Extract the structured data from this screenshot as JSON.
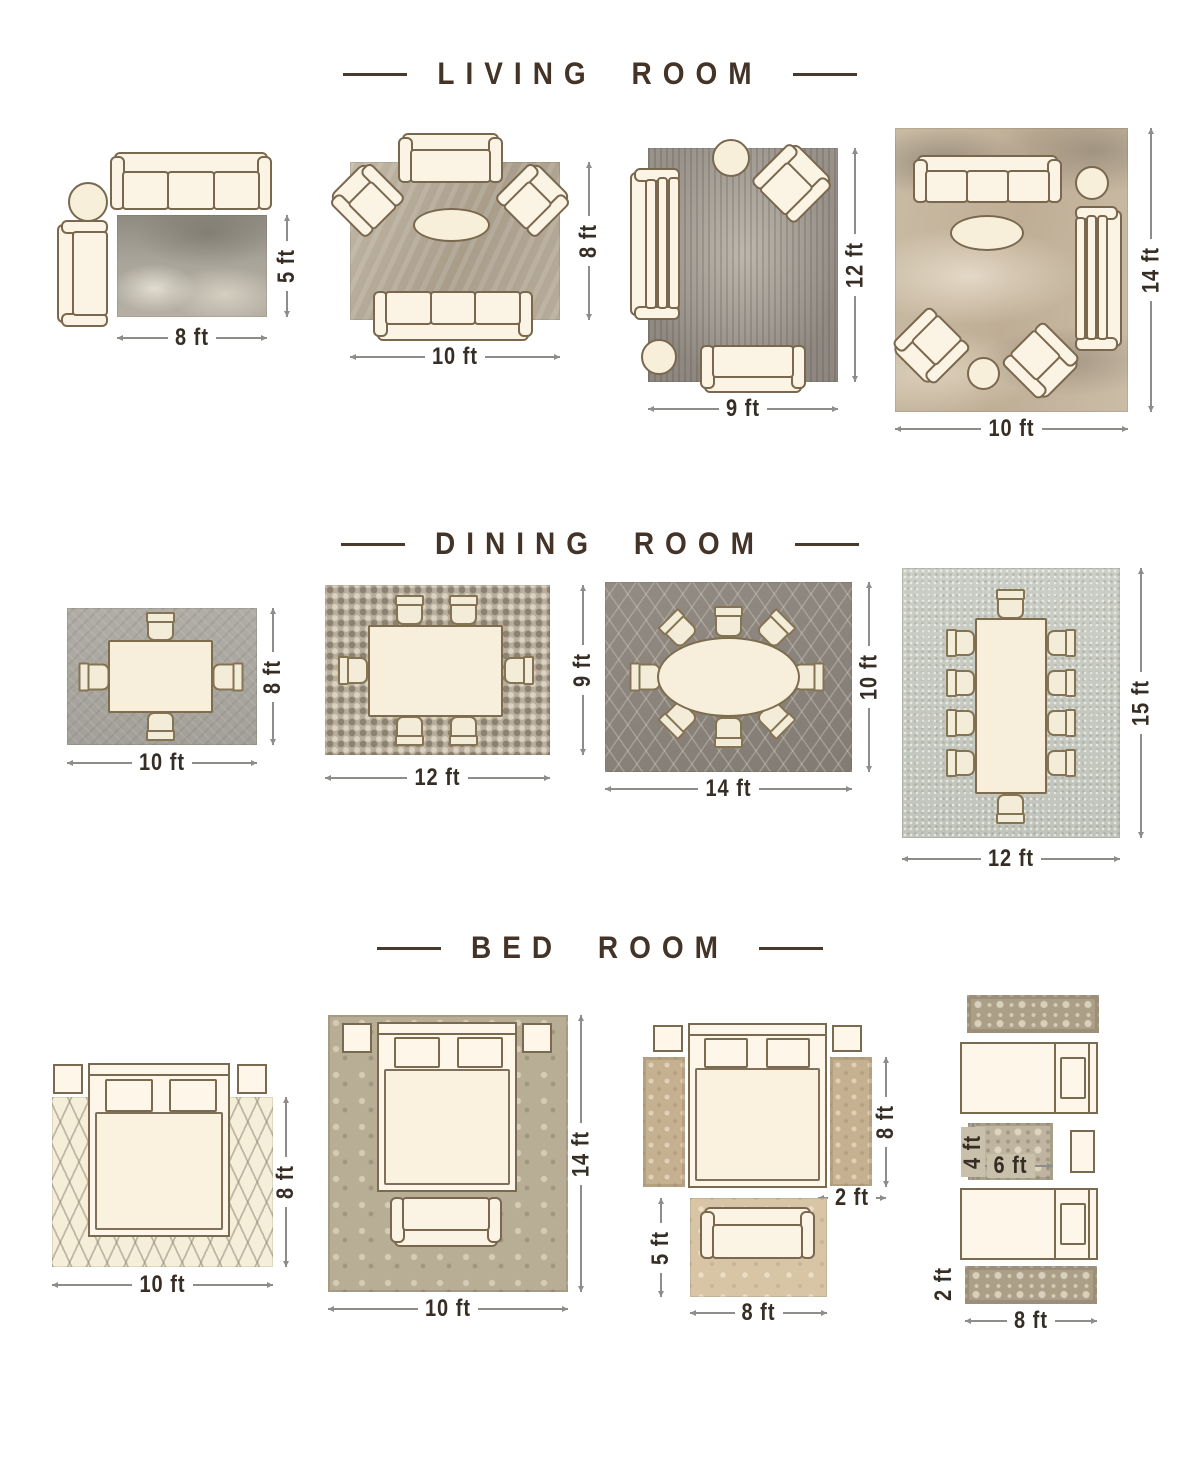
{
  "colors": {
    "background": "#ffffff",
    "title_text": "#443428",
    "dimension_text": "#362d24",
    "dimension_line": "#8e8d89",
    "furniture_fill": "#fbf3e3",
    "furniture_outline": "#79684e"
  },
  "sections": [
    {
      "id": "living-room",
      "title": "LIVING ROOM",
      "layouts": [
        {
          "rug": "8 x 5 ft distressed grey rug",
          "furniture": [
            "3-seat sofa",
            "round side table",
            "chaise"
          ],
          "width_label": "8 ft",
          "height_label": "5 ft"
        },
        {
          "rug": "10 x 8 ft textured beige rug",
          "furniture": [
            "loveseat",
            "2 armchairs",
            "oval coffee table",
            "3-seat sofa"
          ],
          "width_label": "10 ft",
          "height_label": "8 ft"
        },
        {
          "rug": "9 x 12 ft vintage grey rug",
          "furniture": [
            "round side table",
            "armchair",
            "3-seat sofa",
            "round side table",
            "loveseat"
          ],
          "width_label": "9 ft",
          "height_label": "12 ft"
        },
        {
          "rug": "10 x 14 ft abstract beige-grey rug",
          "furniture": [
            "3-seat sofa",
            "round side table",
            "3-seat sofa",
            "oval coffee table",
            "2 armchairs",
            "round side table"
          ],
          "width_label": "10 ft",
          "height_label": "14 ft"
        }
      ]
    },
    {
      "id": "dining-room",
      "title": "DINING ROOM",
      "layouts": [
        {
          "rug": "10 x 8 ft grey rug",
          "furniture": [
            "square dining table",
            "4 chairs"
          ],
          "width_label": "10 ft",
          "height_label": "8 ft"
        },
        {
          "rug": "12 x 9 ft mosaic rug",
          "furniture": [
            "rectangular dining table",
            "6 chairs"
          ],
          "width_label": "12 ft",
          "height_label": "9 ft"
        },
        {
          "rug": "14 x 10 ft lattice rug",
          "furniture": [
            "oval dining table",
            "8 chairs"
          ],
          "width_label": "14 ft",
          "height_label": "10 ft"
        },
        {
          "rug": "12 x 15 ft light grey rug",
          "furniture": [
            "long dining table",
            "10 chairs"
          ],
          "width_label": "12 ft",
          "height_label": "15 ft"
        }
      ]
    },
    {
      "id": "bed-room",
      "title": "BED ROOM",
      "layouts": [
        {
          "rug": "10 x 8 ft cream trellis rug",
          "furniture": [
            "queen bed",
            "2 nightstands"
          ],
          "width_label": "10 ft",
          "height_label": "8 ft"
        },
        {
          "rug": "10 x 14 ft damask rug",
          "furniture": [
            "queen bed",
            "2 nightstands",
            "bench"
          ],
          "width_label": "10 ft",
          "height_label": "14 ft"
        },
        {
          "rug": "two 8 x 2 ft side runners and 8 x 5 ft foot rug",
          "furniture": [
            "queen bed",
            "2 nightstands",
            "settee"
          ],
          "runner_height_label": "8 ft",
          "runner_width_label": "2 ft",
          "rug_height_label": "5 ft",
          "rug_width_label": "8 ft"
        },
        {
          "rug": "two 8 x 2 ft runners and 6 x 4 ft rug between twin beds",
          "furniture": [
            "2 twin beds",
            "nightstand"
          ],
          "mid_rug_height_label": "4 ft",
          "mid_rug_width_label": "6 ft",
          "runner_width_label": "2 ft",
          "runner_length_label": "8 ft"
        }
      ]
    }
  ]
}
